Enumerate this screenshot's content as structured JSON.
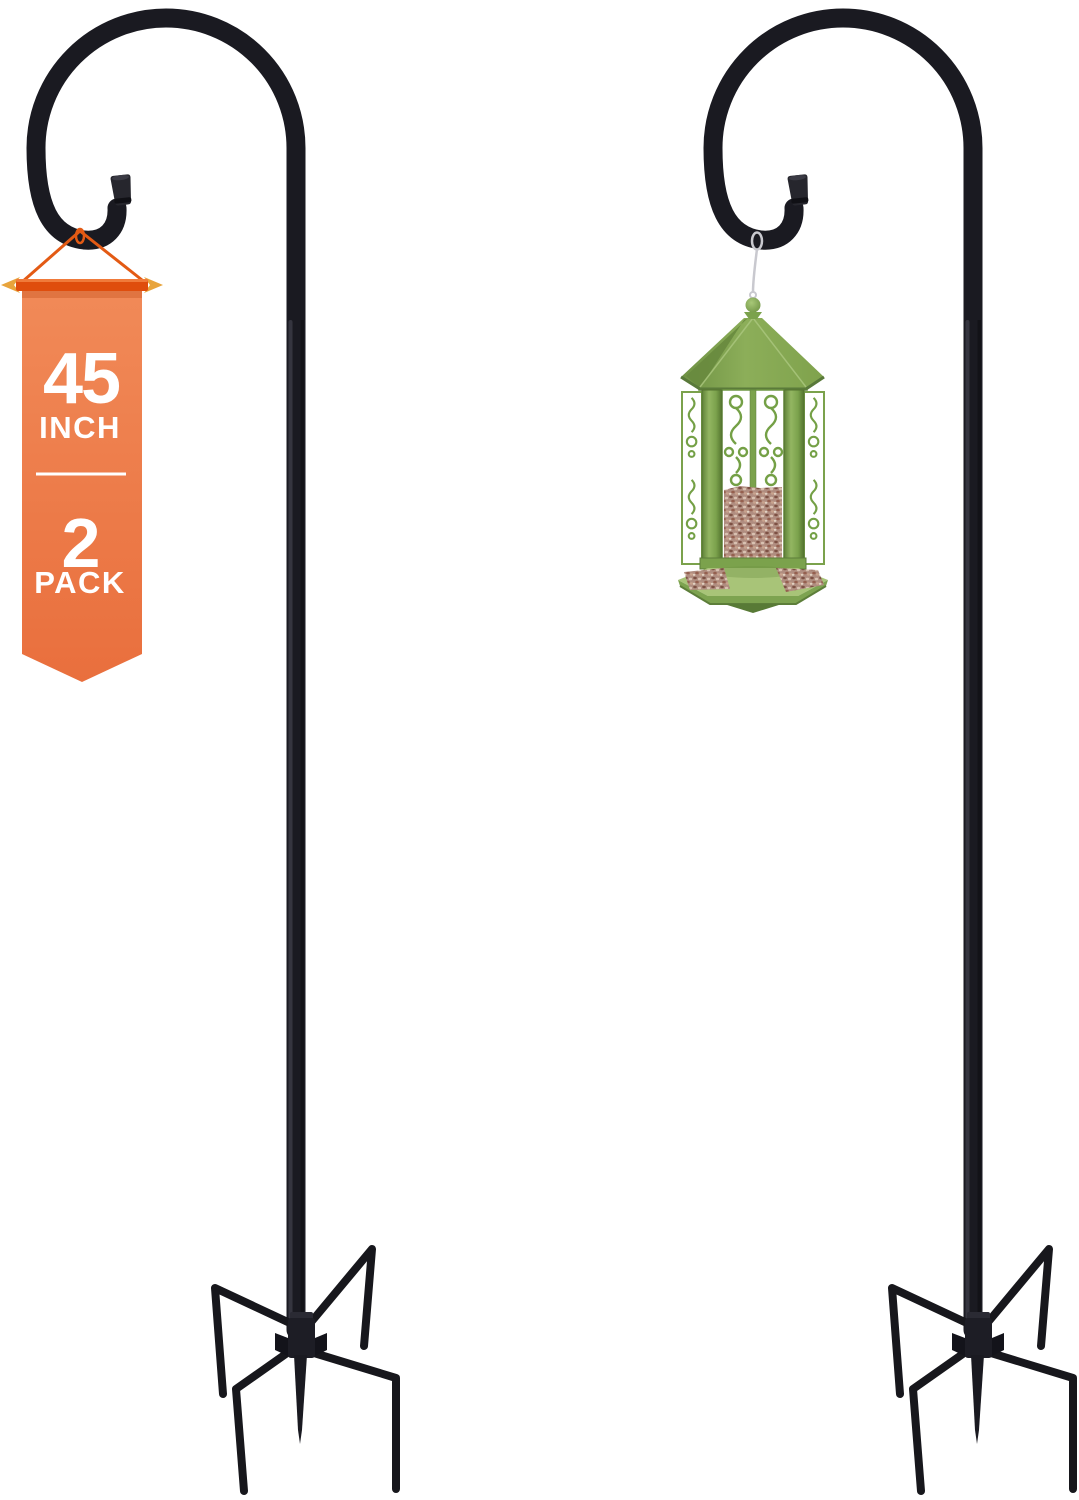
{
  "scene": {
    "background_color": "#ffffff",
    "content": "Two black shepherd-hook garden poles with five-prong stake bases; a green gazebo-style bird feeder filled with seed hangs from the right pole; an orange ribbon badge hangs from the left pole"
  },
  "badge": {
    "size_number": "45",
    "size_unit": "INCH",
    "pack_number": "2",
    "pack_label": "PACK",
    "colors": {
      "ribbon_top": "#f18a58",
      "ribbon_bottom": "#e96f3d",
      "bar": "#df4d0d",
      "arrows": "#e8a43c",
      "string": "#e35a14",
      "text": "#ffffff"
    }
  },
  "poles": {
    "count": 2,
    "prongs_per_base": 5,
    "color": "#1a1a21",
    "highlight": "#3f3f4a",
    "tip_cap_color": "#26262d"
  },
  "feeder": {
    "body_color": "#7ba24c",
    "roof_color": "#8cae59",
    "tray_color": "#a8c478",
    "seed_color": "#b08d80",
    "hanger_wire_color": "#c9c9cf"
  }
}
